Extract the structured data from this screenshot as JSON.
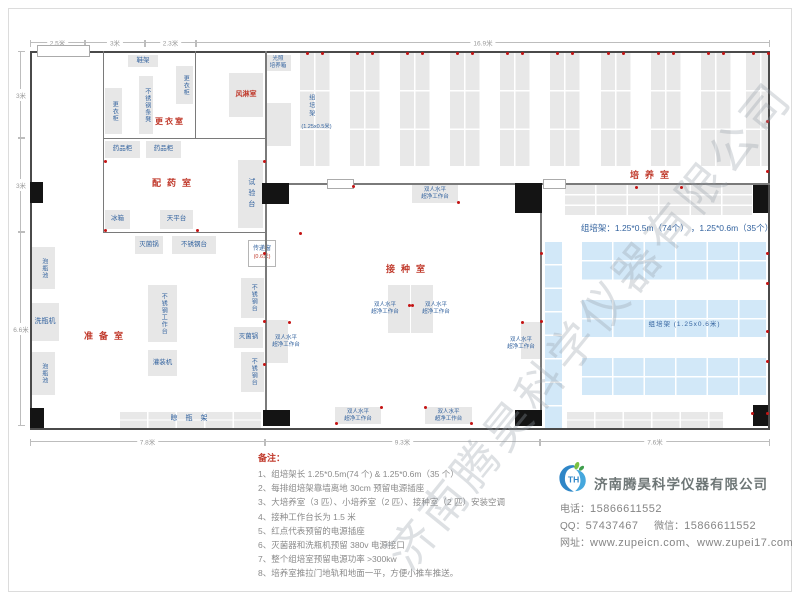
{
  "watermark": "济南腾昊科学仪器有限公司",
  "dims": {
    "top": [
      "2.5米",
      "3米",
      "2.3米",
      "16.9米"
    ],
    "bottom": [
      "7.8米",
      "9.3米",
      "7.6米"
    ],
    "left": [
      "3米",
      "3米",
      "6.6米"
    ]
  },
  "rooms": {
    "dressing": "更衣室",
    "air_shower": "风淋室",
    "pharmacy": "配药室",
    "culture": "培养室",
    "inoculation": "接种室",
    "prep": "准备室"
  },
  "equipment": {
    "shoe_rack": "鞋架",
    "locker": "更衣柜",
    "ss_bench": "不锈钢条凳",
    "light_incubator_l1": "光照",
    "light_incubator_l2": "培养箱",
    "medicine_cabinet": "药品柜",
    "test_bench": "试验台",
    "fridge": "冰箱",
    "balance_table": "天平台",
    "sterilizer": "灭菌锅",
    "ss_table": "不锈钢台",
    "pass_window": "传递窗",
    "pass_window_size": "(0.6米)",
    "soak_pool": "泡瓶池",
    "bottle_washer": "洗瓶机",
    "ss_worktable": "不锈钢工作台",
    "filling_machine": "灌装机",
    "drying_rack": "晾瓶架",
    "bench_l1": "双人水平",
    "bench_l2": "超净工作台",
    "rack_small": "组培架",
    "rack_small_size": "(1.25x0.5米)",
    "rack_big": "组培架 (1.25x0.6米)"
  },
  "rack_note": "组培架：1.25*0.5m（74个） ，1.25*0.6m（35个）",
  "notes": {
    "title": "备注：",
    "items": [
      "1、组培架长 1.25*0.5m(74 个) & 1.25*0.6m（35 个）",
      "2、每排组培架靠墙离地 30cm 预留电源插座",
      "3、大培养室（3 匹）、小培养室（2 匹）、接种室（2 匹）安装空调",
      "4、接种工作台长为 1.5 米",
      "5、红点代表预留的电源插座",
      "6、灭菌器和洗瓶机预留 380v 电源接口",
      "7、整个组培室预留电源功率 >300kw",
      "8、培养室推拉门地轨和地面一平，方便小推车推送。"
    ]
  },
  "company": {
    "name": "济南腾昊科学仪器有限公司",
    "phone_label": "电话：",
    "phone": "15866611552",
    "qq_label": "QQ：",
    "qq": "57437467",
    "wechat_label": "微信：",
    "wechat": "15866611552",
    "web_label": "网址：",
    "websites": "www.zupeicn.com、www.zupei17.com"
  },
  "colors": {
    "room_label": "#c0392b",
    "equipment_label": "#33639f",
    "rack_blue": "#d2e8f8",
    "outlet_red": "#c41414"
  }
}
